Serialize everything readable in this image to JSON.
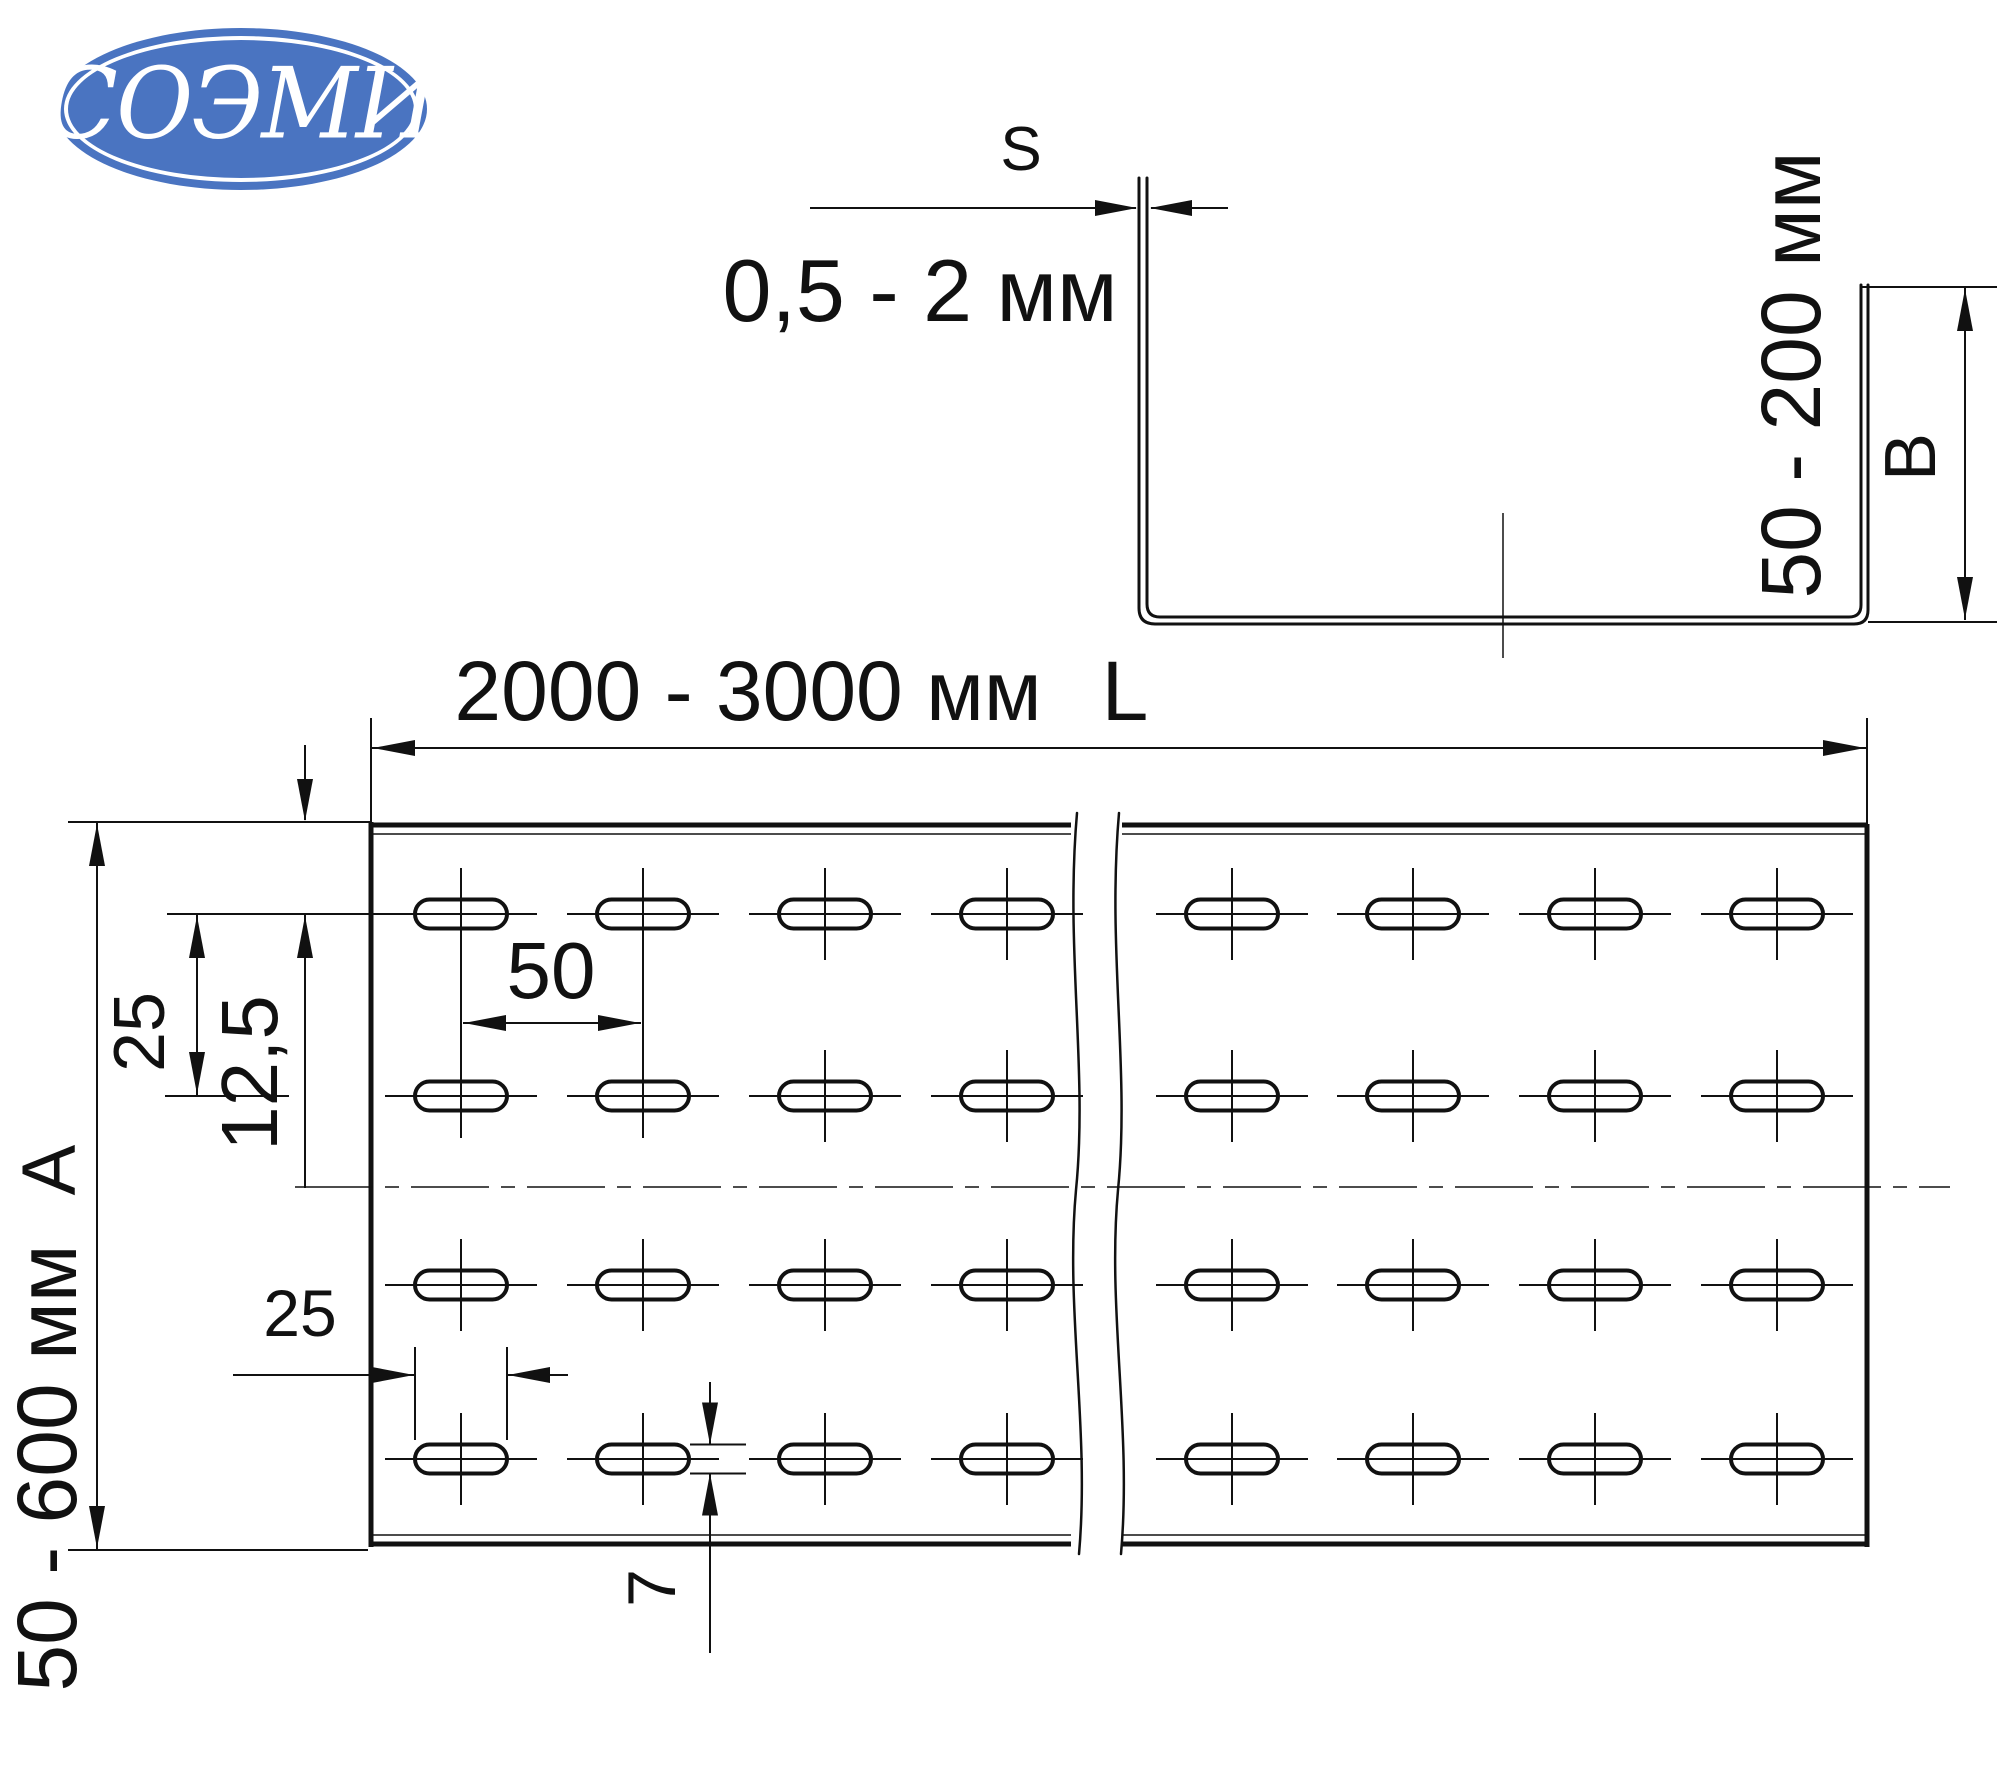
{
  "logo": {
    "text": "СОЭМИ",
    "bg_color": "#4a74c1",
    "text_color": "#ffffff"
  },
  "labels": {
    "s": "S",
    "thickness_range": "0,5 - 2 мм",
    "height_range": "50 - 200 мм",
    "b": "B",
    "length_range": "2000 - 3000 мм",
    "l": "L",
    "hole_spacing": "50",
    "row_spacing": "25",
    "row_offset": "12,5",
    "a": "A",
    "width_range": "50 - 600 мм",
    "slot_length": "25",
    "slot_width": "7"
  },
  "dimensions": [
    {
      "symbol": "S",
      "value": "0,5 - 2 мм"
    },
    {
      "symbol": "B",
      "value": "50 - 200 мм"
    },
    {
      "symbol": "L",
      "value": "2000 - 3000 мм"
    },
    {
      "symbol": "A",
      "value": "50 - 600 мм"
    },
    {
      "value": "12,5"
    },
    {
      "value": "25"
    },
    {
      "value": "50"
    },
    {
      "value": "25"
    },
    {
      "value": "7"
    }
  ],
  "colors": {
    "line": "#111111",
    "background": "#ffffff"
  },
  "geometry": {
    "plan": {
      "left": 371,
      "right": 1867,
      "top": 825,
      "bottom": 1544,
      "wavy_x": [
        1077,
        1119
      ],
      "cols": [
        461,
        643,
        825,
        1007,
        1232,
        1413,
        1595,
        1777
      ],
      "rows": [
        914,
        1096,
        1285,
        1459
      ],
      "slot_len": 92,
      "slot_wid": 29,
      "centerline_y": 1187
    },
    "channel": {
      "left_outer": 1139,
      "left_inner": 1147,
      "right_outer": 1868,
      "right_inner": 1861,
      "bottom_outer": 624,
      "bottom_inner": 617,
      "left_wall_top": 178,
      "right_wall_top": 285,
      "centerline_x": 1503
    }
  }
}
